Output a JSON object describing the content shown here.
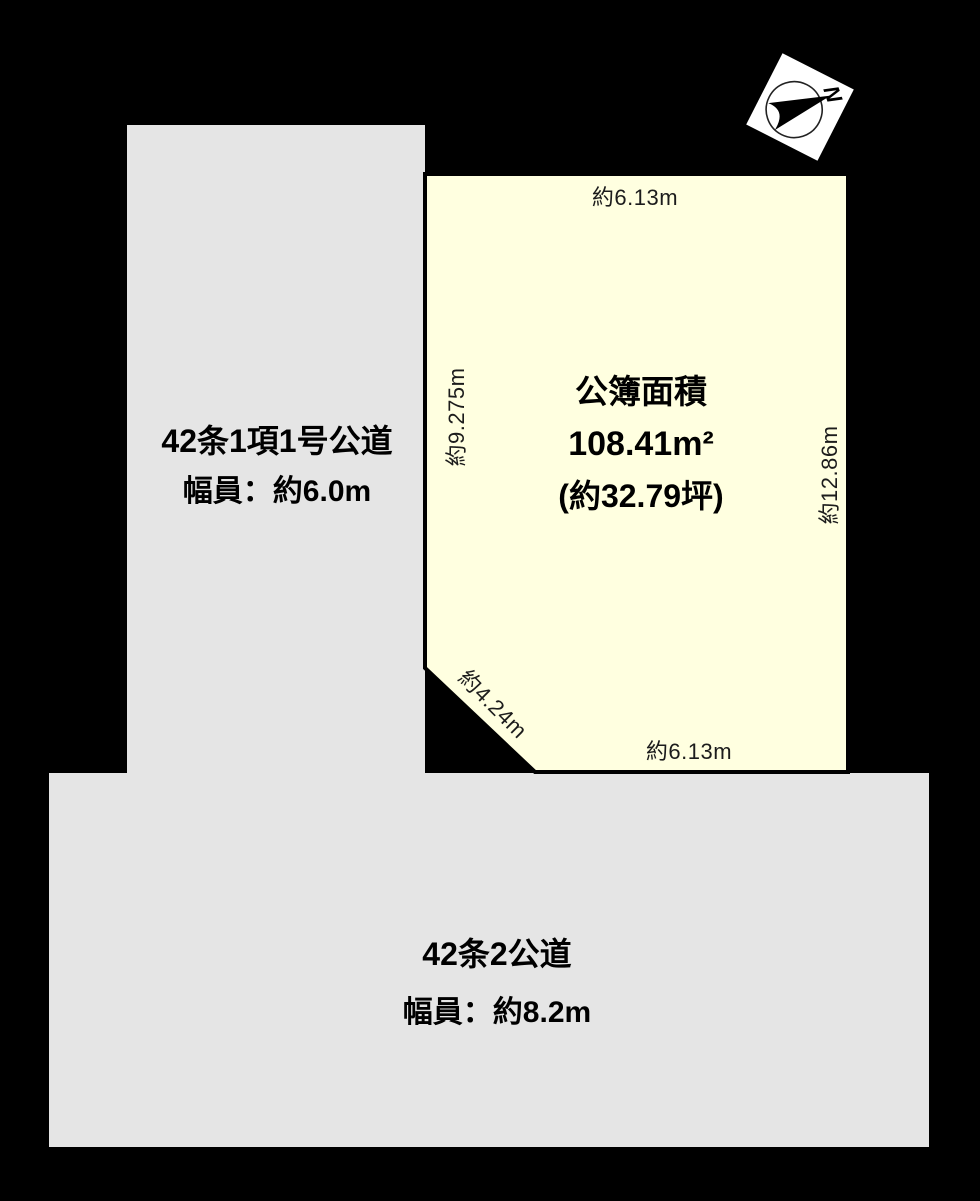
{
  "diagram": {
    "colors": {
      "background": "#000000",
      "road_fill": "#e5e5e5",
      "plot_fill": "#ffffe0",
      "plot_border": "#000000",
      "label_text": "#000000",
      "dim_text": "#1c1c1c",
      "compass_bg": "#ffffff"
    },
    "compass": {
      "label": "N"
    },
    "plot": {
      "area_line1": "公簿面積",
      "area_line2": "108.41m²",
      "area_line3": "(約32.79坪)",
      "dim_top": "約6.13m",
      "dim_left": "約9.275m",
      "dim_right": "約12.86m",
      "dim_diagonal": "約4.24m",
      "dim_bottom": "約6.13m"
    },
    "roads": {
      "left": {
        "name": "42条1項1号公道",
        "width": "幅員：約6.0m"
      },
      "bottom": {
        "name": "42条2公道",
        "width": "幅員：約8.2m"
      }
    }
  }
}
